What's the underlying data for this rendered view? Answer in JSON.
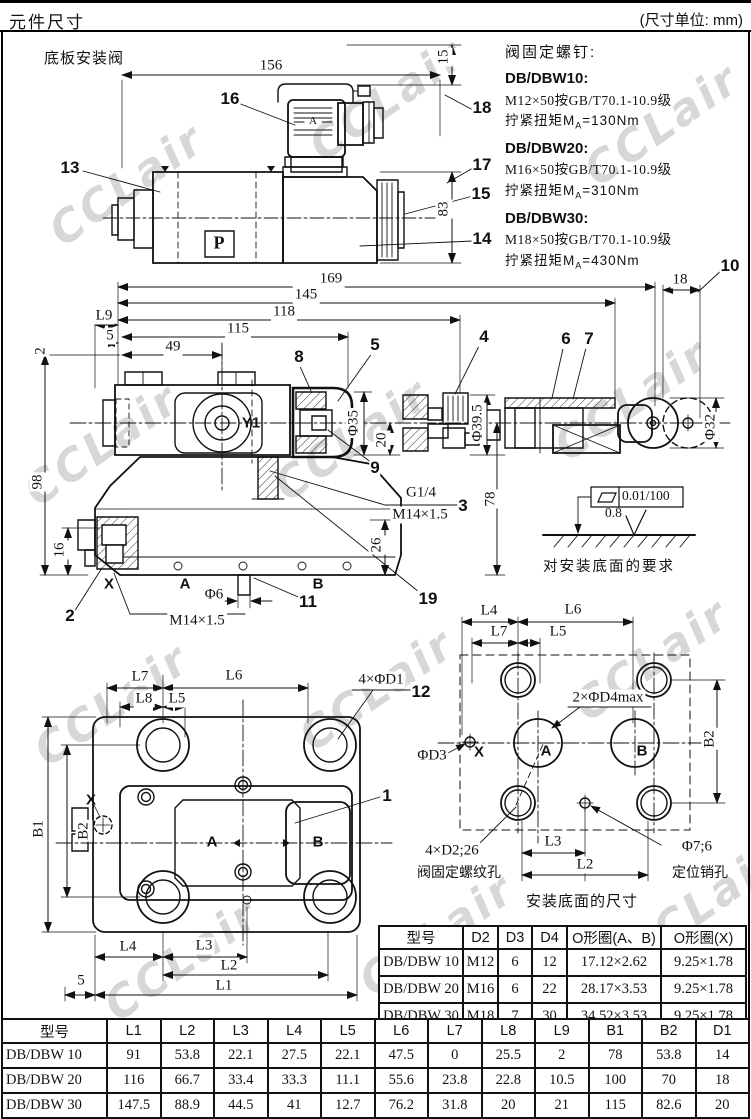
{
  "page": {
    "title": "元件尺寸",
    "unit_note": "(尺寸单位: mm)"
  },
  "section_label": "底板安装阀",
  "watermark": "CCLair",
  "screw_notes": {
    "title": "阀固定螺钉:",
    "items": [
      {
        "model": "DB/DBW10:",
        "spec": "M12×50按GB/T70.1-10.9级",
        "torque_pre": "拧紧扭矩M",
        "torque_sub": "A",
        "torque_post": "=130Nm"
      },
      {
        "model": "DB/DBW20:",
        "spec": "M16×50按GB/T70.1-10.9级",
        "torque_pre": "拧紧扭矩M",
        "torque_sub": "A",
        "torque_post": "=310Nm"
      },
      {
        "model": "DB/DBW30:",
        "spec": "M18×50按GB/T70.1-10.9级",
        "torque_pre": "拧紧扭矩M",
        "torque_sub": "A",
        "torque_post": "=430Nm"
      }
    ]
  },
  "surface_note": {
    "flatness": "0.01/100",
    "roughness": "0.8",
    "caption": "对安装底面的要求"
  },
  "captions": {
    "mounting_face": "安装底面的尺寸"
  },
  "labels": {
    "d1": [
      {
        "t": "156",
        "x": 271,
        "y": 66,
        "c": "dim"
      },
      {
        "t": "15",
        "x": 444,
        "y": 57,
        "c": "dim dimv"
      },
      {
        "t": "83",
        "x": 444,
        "y": 209,
        "c": "dim dimv"
      },
      {
        "t": "16",
        "x": 230,
        "y": 99,
        "c": "callout"
      },
      {
        "t": "13",
        "x": 70,
        "y": 168,
        "c": "callout"
      },
      {
        "t": "18",
        "x": 482,
        "y": 108,
        "c": "callout"
      },
      {
        "t": "17",
        "x": 482,
        "y": 165,
        "c": "callout"
      },
      {
        "t": "15",
        "x": 481,
        "y": 194,
        "c": "callout"
      },
      {
        "t": "14",
        "x": 482,
        "y": 239,
        "c": "callout"
      },
      {
        "t": "A",
        "x": 313,
        "y": 121,
        "c": "tiny",
        "n": "connector-a-mark"
      },
      {
        "t": "P",
        "x": 219,
        "y": 243,
        "c": "pmark",
        "n": "p-port-mark"
      }
    ],
    "d2": [
      {
        "t": "169",
        "x": 331,
        "y": 279,
        "c": "dim"
      },
      {
        "t": "145",
        "x": 306,
        "y": 295,
        "c": "dim"
      },
      {
        "t": "118",
        "x": 284,
        "y": 312,
        "c": "dim"
      },
      {
        "t": "115",
        "x": 238,
        "y": 329,
        "c": "dim"
      },
      {
        "t": "49",
        "x": 173,
        "y": 347,
        "c": "dim"
      },
      {
        "t": "L9",
        "x": 104,
        "y": 316,
        "c": "dim"
      },
      {
        "t": "5",
        "x": 110,
        "y": 336,
        "c": "dim"
      },
      {
        "t": "2",
        "x": 41,
        "y": 351,
        "c": "dim dimv"
      },
      {
        "t": "98",
        "x": 38,
        "y": 482,
        "c": "dim dimv"
      },
      {
        "t": "16",
        "x": 60,
        "y": 550,
        "c": "dim dimv"
      },
      {
        "t": "18",
        "x": 680,
        "y": 280,
        "c": "dim"
      },
      {
        "t": "10",
        "x": 730,
        "y": 266,
        "c": "callout"
      },
      {
        "t": "8",
        "x": 299,
        "y": 357,
        "c": "callout"
      },
      {
        "t": "5",
        "x": 375,
        "y": 345,
        "c": "callout"
      },
      {
        "t": "4",
        "x": 484,
        "y": 337,
        "c": "callout"
      },
      {
        "t": "6",
        "x": 566,
        "y": 339,
        "c": "callout"
      },
      {
        "t": "7",
        "x": 589,
        "y": 339,
        "c": "callout"
      },
      {
        "t": "9",
        "x": 375,
        "y": 468,
        "c": "callout"
      },
      {
        "t": "3",
        "x": 463,
        "y": 506,
        "c": "callout"
      },
      {
        "t": "19",
        "x": 428,
        "y": 599,
        "c": "callout"
      },
      {
        "t": "11",
        "x": 308,
        "y": 602,
        "c": "callout"
      },
      {
        "t": "2",
        "x": 70,
        "y": 616,
        "c": "callout"
      },
      {
        "t": "Y1",
        "x": 251,
        "y": 423,
        "c": "port"
      },
      {
        "t": "X",
        "x": 109,
        "y": 584,
        "c": "port"
      },
      {
        "t": "A",
        "x": 185,
        "y": 584,
        "c": "port"
      },
      {
        "t": "B",
        "x": 318,
        "y": 584,
        "c": "port"
      },
      {
        "t": "Φ35",
        "x": 354,
        "y": 423,
        "c": "dim dimv"
      },
      {
        "t": "20",
        "x": 382,
        "y": 440,
        "c": "dim dimv"
      },
      {
        "t": "Φ39.5",
        "x": 478,
        "y": 423,
        "c": "dim dimv"
      },
      {
        "t": "78",
        "x": 491,
        "y": 499,
        "c": "dim dimv"
      },
      {
        "t": "26",
        "x": 377,
        "y": 545,
        "c": "dim dimv"
      },
      {
        "t": "Φ32",
        "x": 711,
        "y": 427,
        "c": "dim dimv"
      },
      {
        "t": "Φ6",
        "x": 214,
        "y": 595,
        "c": "dim"
      },
      {
        "t": "M14×1.5",
        "x": 197,
        "y": 621,
        "c": "dim"
      },
      {
        "t": "G1/4",
        "x": 421,
        "y": 493,
        "c": "dim"
      },
      {
        "t": "M14×1.5",
        "x": 420,
        "y": 515,
        "c": "dim"
      }
    ],
    "d3": [
      {
        "t": "L7",
        "x": 140,
        "y": 677,
        "c": "dim"
      },
      {
        "t": "L6",
        "x": 234,
        "y": 676,
        "c": "dim"
      },
      {
        "t": "L8",
        "x": 144,
        "y": 699,
        "c": "dim"
      },
      {
        "t": "L5",
        "x": 177,
        "y": 699,
        "c": "dim"
      },
      {
        "t": "4×ΦD1",
        "x": 381,
        "y": 680,
        "c": "dim"
      },
      {
        "t": "12",
        "x": 421,
        "y": 692,
        "c": "callout"
      },
      {
        "t": "1",
        "x": 387,
        "y": 796,
        "c": "callout"
      },
      {
        "t": "B1",
        "x": 39,
        "y": 829,
        "c": "dim dimv"
      },
      {
        "t": "B2",
        "x": 84,
        "y": 831,
        "c": "dim dimv"
      },
      {
        "t": "X",
        "x": 91,
        "y": 800,
        "c": "port"
      },
      {
        "t": "A",
        "x": 212,
        "y": 842,
        "c": "port"
      },
      {
        "t": "B",
        "x": 318,
        "y": 842,
        "c": "port"
      },
      {
        "t": "L4",
        "x": 128,
        "y": 947,
        "c": "dim"
      },
      {
        "t": "L3",
        "x": 204,
        "y": 946,
        "c": "dim"
      },
      {
        "t": "L2",
        "x": 229,
        "y": 966,
        "c": "dim"
      },
      {
        "t": "L1",
        "x": 224,
        "y": 986,
        "c": "dim"
      },
      {
        "t": "5",
        "x": 81,
        "y": 981,
        "c": "dim"
      }
    ],
    "d4": [
      {
        "t": "L4",
        "x": 489,
        "y": 611,
        "c": "dim"
      },
      {
        "t": "L6",
        "x": 573,
        "y": 610,
        "c": "dim"
      },
      {
        "t": "L7",
        "x": 499,
        "y": 632,
        "c": "dim"
      },
      {
        "t": "L5",
        "x": 558,
        "y": 632,
        "c": "dim"
      },
      {
        "t": "2×ΦD4max",
        "x": 608,
        "y": 698,
        "c": "dim"
      },
      {
        "t": "ΦD3",
        "x": 432,
        "y": 756,
        "c": "dim"
      },
      {
        "t": "X",
        "x": 479,
        "y": 752,
        "c": "port"
      },
      {
        "t": "A",
        "x": 546,
        "y": 751,
        "c": "port"
      },
      {
        "t": "B",
        "x": 642,
        "y": 751,
        "c": "port"
      },
      {
        "t": "B2",
        "x": 710,
        "y": 739,
        "c": "dim dimv"
      },
      {
        "t": "L3",
        "x": 553,
        "y": 842,
        "c": "dim"
      },
      {
        "t": "L2",
        "x": 585,
        "y": 865,
        "c": "dim"
      },
      {
        "t": "4×D2;26",
        "x": 452,
        "y": 851,
        "c": "dim"
      },
      {
        "t": "阀固定螺纹孔",
        "x": 459,
        "y": 872,
        "c": "cjk"
      },
      {
        "t": "Φ7;6",
        "x": 697,
        "y": 847,
        "c": "dim"
      },
      {
        "t": "定位销孔",
        "x": 700,
        "y": 872,
        "c": "cjk"
      }
    ]
  },
  "oring_table": {
    "headers": [
      "型号",
      "D2",
      "D3",
      "D4",
      "O形圈(A、B)",
      "O形圈(X)"
    ],
    "rows": [
      [
        "DB/DBW 10",
        "M12",
        "6",
        "12",
        "17.12×2.62",
        "9.25×1.78"
      ],
      [
        "DB/DBW 20",
        "M16",
        "6",
        "22",
        "28.17×3.53",
        "9.25×1.78"
      ],
      [
        "DB/DBW 30",
        "M18",
        "7",
        "30",
        "34.52×3.53",
        "9.25×1.78"
      ]
    ]
  },
  "dims_table": {
    "headers": [
      "型号",
      "L1",
      "L2",
      "L3",
      "L4",
      "L5",
      "L6",
      "L7",
      "L8",
      "L9",
      "B1",
      "B2",
      "D1"
    ],
    "rows": [
      [
        "DB/DBW 10",
        "91",
        "53.8",
        "22.1",
        "27.5",
        "22.1",
        "47.5",
        "0",
        "25.5",
        "2",
        "78",
        "53.8",
        "14"
      ],
      [
        "DB/DBW 20",
        "116",
        "66.7",
        "33.4",
        "33.3",
        "11.1",
        "55.6",
        "23.8",
        "22.8",
        "10.5",
        "100",
        "70",
        "18"
      ],
      [
        "DB/DBW 30",
        "147.5",
        "88.9",
        "44.5",
        "41",
        "12.7",
        "76.2",
        "31.8",
        "20",
        "21",
        "115",
        "82.6",
        "20"
      ]
    ]
  }
}
